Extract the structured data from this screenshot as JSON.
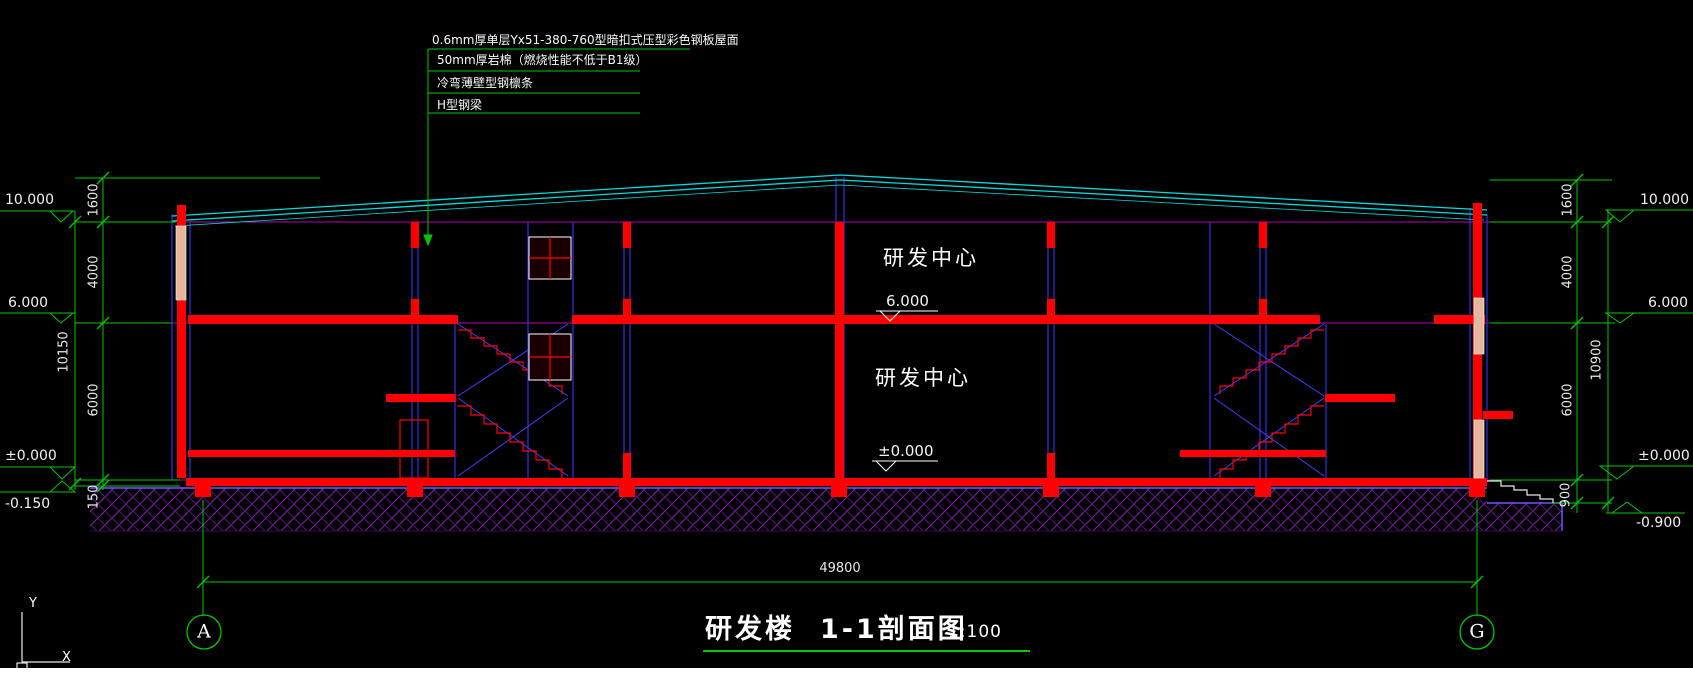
{
  "drawing": {
    "title_block": {
      "building": "研发楼",
      "view": "1-1剖面图",
      "scale": "1:100"
    },
    "roof_notes": [
      "0.6mm厚单层Yx51-380-760型暗扣式压型彩色钢板屋面",
      "50mm厚岩棉（燃烧性能不低于B1级）",
      "冷弯薄壁型钢檩条",
      "H型钢梁"
    ],
    "rooms": [
      "研发中心",
      "研发中心"
    ],
    "floor_marks": [
      "6.000",
      "±0.000"
    ],
    "dims": {
      "left": {
        "elevations": [
          "10.000",
          "6.000",
          "±0.000",
          "-0.150"
        ],
        "segments": [
          "1600",
          "4000",
          "6000",
          "150"
        ],
        "total": "10150"
      },
      "right": {
        "elevations": [
          "10.000",
          "6.000",
          "±0.000",
          "-0.900"
        ],
        "segments": [
          "1600",
          "4000",
          "6000",
          "900"
        ],
        "total": "10900"
      },
      "overall_width": "49800"
    },
    "grid": {
      "left_bubble": "A",
      "right_bubble": "G"
    },
    "ucs": {
      "x": "X",
      "y": "Y"
    },
    "colors": {
      "dim_green": "#00c800",
      "structure_red": "#ff0000",
      "roof_cyan": "#00dcdc",
      "wall_blue": "#3232e6",
      "level_magenta": "#b400b4",
      "ground_violet": "#7850ff",
      "hatch_purple": "#8a1fb4",
      "text_white": "#ffffff"
    }
  }
}
